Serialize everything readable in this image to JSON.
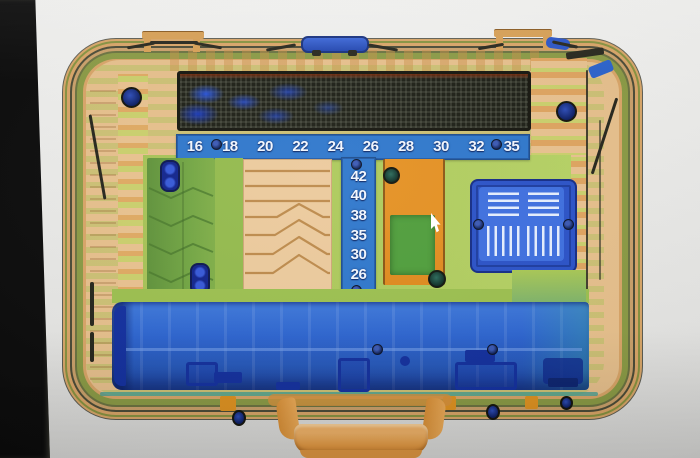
{
  "viewer": {
    "content": "xray-scan-tool-case",
    "scales": {
      "top": {
        "labels": [
          "16",
          "18",
          "20",
          "22",
          "24",
          "26",
          "28",
          "30",
          "32",
          "35"
        ]
      },
      "side": {
        "labels": [
          "42",
          "40",
          "38",
          "35",
          "30",
          "26"
        ]
      }
    },
    "icons": {
      "cursor": "arrow-cursor",
      "rivets": "rivet-dot",
      "pins": "double-pin"
    },
    "colors": {
      "scale_blue": "#2e77cc",
      "metal_navy": "#122f9e",
      "organic_orange": "#e28a1d",
      "mixed_green": "#adc95c",
      "dark_dense": "#1c1e15",
      "case_tan": "#e7c08c",
      "handle_orange": "#e49a43",
      "bezel_black": "#0b0b0b"
    }
  }
}
